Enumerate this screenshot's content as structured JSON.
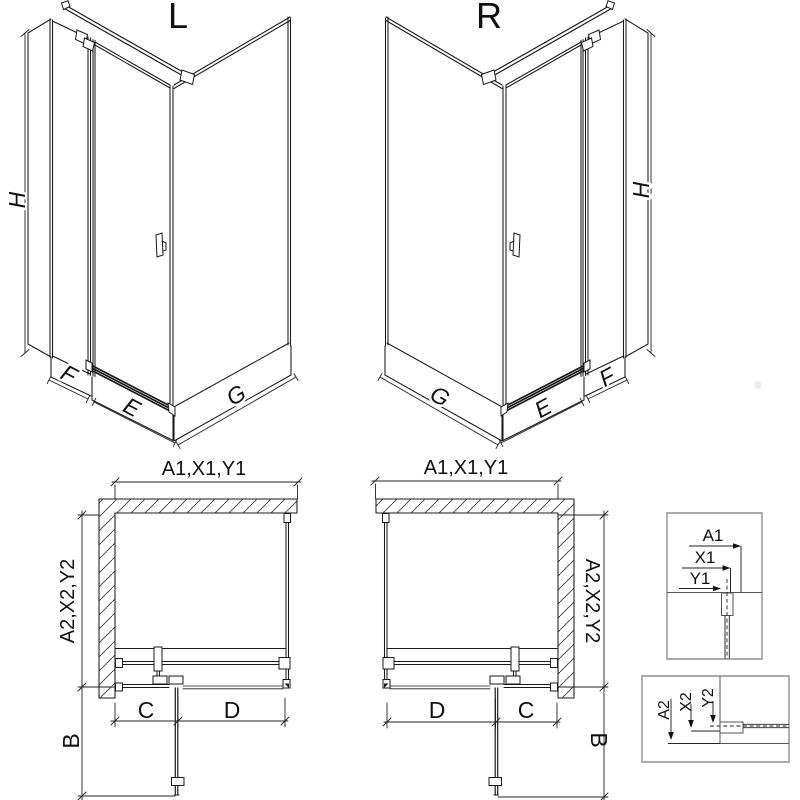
{
  "views": {
    "iso_left": {
      "variant": "L",
      "height": "H",
      "fixed_width": "F",
      "door_width": "E",
      "side_width": "G"
    },
    "iso_right": {
      "variant": "R",
      "height": "H",
      "fixed_width": "F",
      "door_width": "E",
      "side_width": "G"
    },
    "plan_left": {
      "width": "A1,X1,Y1",
      "depth": "A2,X2,Y2",
      "door_swing": "B",
      "fixed_section": "C",
      "door_section": "D"
    },
    "plan_right": {
      "width": "A1,X1,Y1",
      "depth": "A2,X2,Y2",
      "door_swing": "B",
      "fixed_section": "C",
      "door_section": "D"
    }
  },
  "details": {
    "width_detail": {
      "wall": "A1",
      "profile": "X1",
      "glass": "Y1"
    },
    "depth_detail": {
      "wall": "A2",
      "profile": "X2",
      "glass": "Y2"
    }
  },
  "colors": {
    "line": "#1a1a1a",
    "dim": "#222222",
    "detail_frame": "#8f8f8f",
    "background": "#ffffff"
  }
}
